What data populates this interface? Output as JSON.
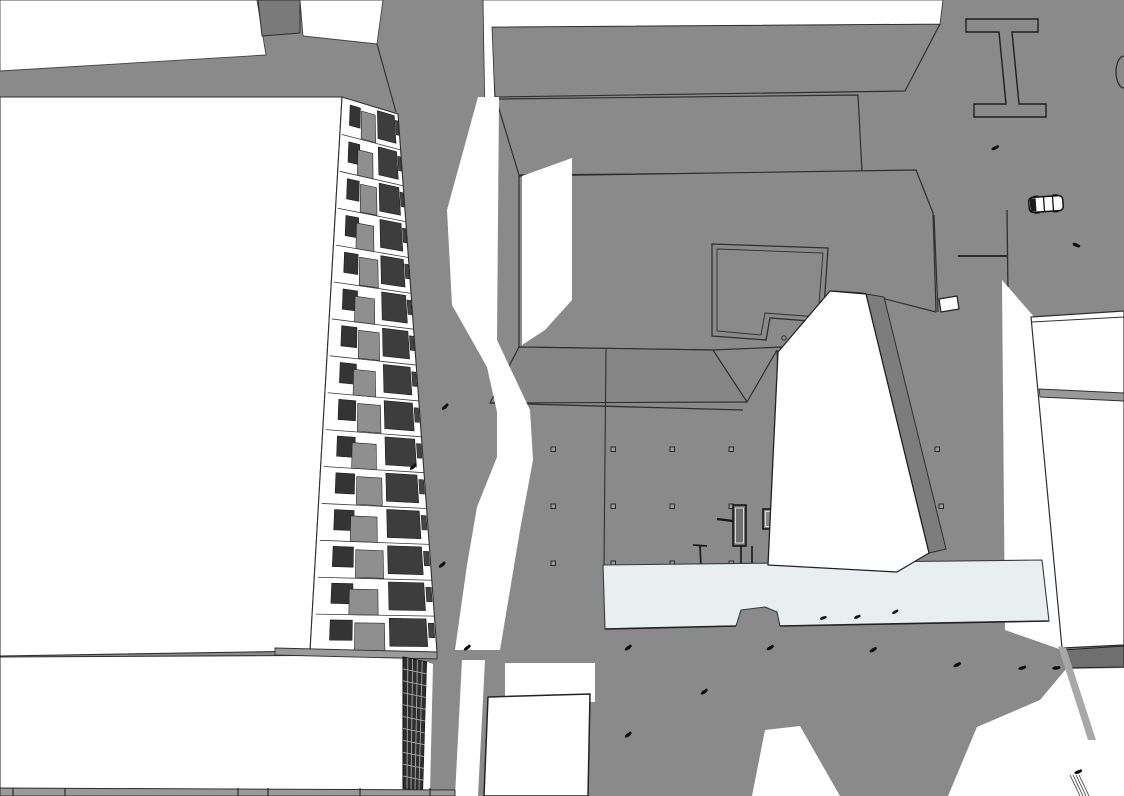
{
  "scene": {
    "name": "monochrome-3d-city-massing-model-aerial-view",
    "style": "sketch-render-white-volumes-gray-shadows",
    "colors": {
      "ground": "#8a8a8a",
      "sunlit": "#ffffff",
      "pale_deck": "#e9eef1",
      "outline": "#2f2f2f",
      "dark_detail": "#161616",
      "window_dark": "#343434",
      "window_dark2": "#3d3d3d",
      "balcony_gray": "#8f8f8f",
      "wall_shade": "#7a7a7a",
      "tower_side": "#7d7d7d",
      "band_gray": "#9a9a9a",
      "band_dark": "#6f6f6f",
      "parapet_face": "#868686",
      "grid_face": "#2e2e2e",
      "grid_line": "#a8a8a8",
      "soft_shadow": "#a8a8a8"
    },
    "entities": {
      "people": [
        [
          995,
          148,
          -25
        ],
        [
          1076,
          245,
          25
        ],
        [
          445,
          407,
          -40
        ],
        [
          413,
          467,
          -40
        ],
        [
          442,
          565,
          -40
        ],
        [
          467,
          648,
          -35
        ],
        [
          628,
          648,
          -35
        ],
        [
          628,
          735,
          -35
        ],
        [
          704,
          692,
          -35
        ],
        [
          770,
          648,
          -30
        ],
        [
          873,
          650,
          -30
        ],
        [
          957,
          665,
          -25
        ],
        [
          1022,
          668,
          -15
        ],
        [
          1056,
          668,
          -5
        ],
        [
          1078,
          772,
          -20
        ]
      ],
      "deck_people": [
        [
          823,
          618,
          -20
        ],
        [
          857,
          617,
          -25
        ],
        [
          895,
          612,
          -30
        ]
      ],
      "car": {
        "x": 1046,
        "y": 204,
        "rot": -4
      },
      "plaza_dots": {
        "cols": [
          553,
          613,
          672,
          731
        ],
        "rows": [
          449,
          506,
          563
        ],
        "extra": [
          [
            937,
            449
          ],
          [
            941,
            506
          ]
        ]
      },
      "left_facade_floors": 15,
      "end_grid": {
        "cols": 5,
        "rows": 11
      }
    }
  }
}
